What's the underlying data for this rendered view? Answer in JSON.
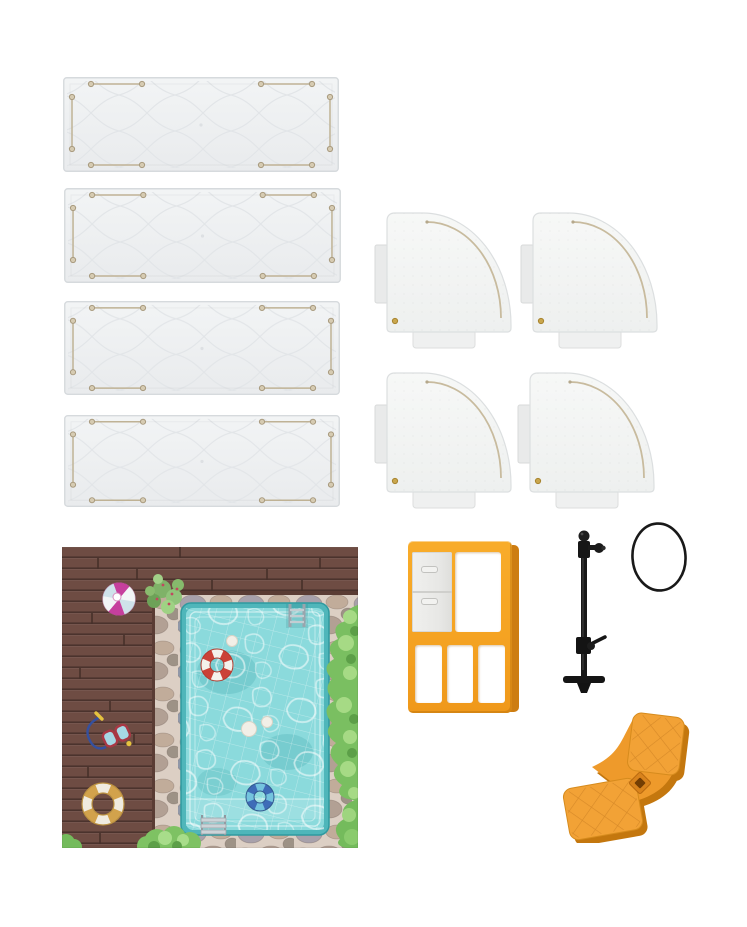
{
  "scene": {
    "description": "Product photo of miniature poolside playset parts laid out on a white background",
    "background": "#ffffff",
    "width": 747,
    "height": 927
  },
  "colors": {
    "wall": "#eef0f2",
    "wall_edge": "#d6dadd",
    "quilt": "#e2e5e8",
    "slot": "#bfb295",
    "roof": "#f5f6f5",
    "groove": "#c8bb9e",
    "deck": "#6e4c43",
    "deck_line": "#4b332d",
    "stone": "#dccfc4",
    "water": "#8bdadc",
    "rim": "#4fb6ba",
    "bush": "#7abf61",
    "orange": "#f5a322",
    "orange_side": "#cd7d12",
    "slide_orange": "#f2a236",
    "slide_shadow": "#c4770e",
    "black": "#1a1a1a",
    "magenta": "#c63f9d",
    "ring_red": "#cb4237",
    "ring_yellow": "#d2a24c",
    "ring_blue": "#3e6cb7"
  },
  "parts": [
    {
      "name": "Wall panel",
      "quantity": 4,
      "color": "light gray",
      "description": "Long rectangular wall panel with quilted diamond embossing and connector slots"
    },
    {
      "name": "Quarter-round panel",
      "quantity": 4,
      "color": "white",
      "description": "Fan-shaped quarter-circle panel with curved groove, side tab and bottom tab"
    },
    {
      "name": "Poolside base mat",
      "quantity": 1,
      "color": "multicolor",
      "description": "Printed mat with wooden deck, stone border, swimming pool, floats and bushes"
    },
    {
      "name": "Window frame with shutter",
      "quantity": 1,
      "color": "orange",
      "description": "Orange lattice window frame with white sliding shutter and three lower openings"
    },
    {
      "name": "Shower stand pole",
      "quantity": 1,
      "color": "black",
      "description": "Black pole with top ball, side bracket, middle clamp lever and foot base"
    },
    {
      "name": "Elastic ring",
      "quantity": 1,
      "color": "black",
      "description": "Thin black oval elastic band"
    },
    {
      "name": "Curved slide",
      "quantity": 1,
      "color": "orange",
      "description": "Orange S-curved slide piece with quilted pads and square mounting hole"
    }
  ],
  "mat_props": [
    "pink striped beach ball",
    "green potted plant",
    "red and white life ring",
    "yellow and white life ring",
    "blue swim ring",
    "snorkel mask",
    "pool ladder",
    "pool steps",
    "green bushes",
    "white pebbles"
  ]
}
